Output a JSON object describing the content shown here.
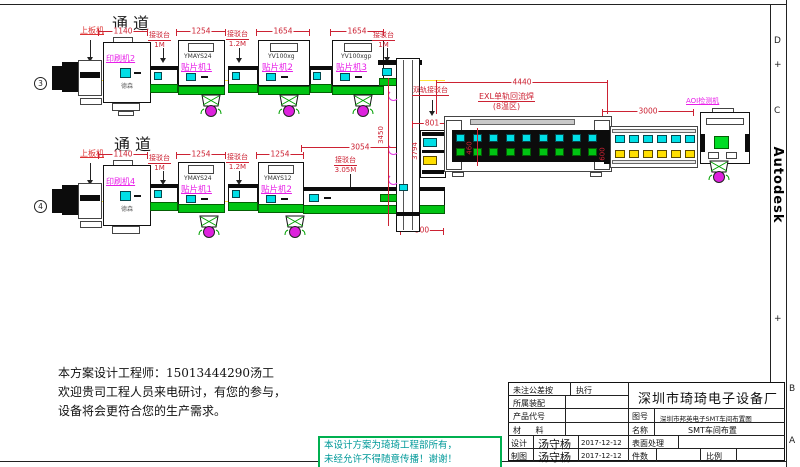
{
  "colors": {
    "dim_red": "#cc2233",
    "label_magenta": "#e81ee8",
    "conveyor_green": "#00c413",
    "slot_cyan": "#00dfe6",
    "slot_yellow": "#ffdf00",
    "machine_black": "#0c0c0c",
    "stamp_teal": "#009999",
    "stamp_border_green": "#00b050"
  },
  "row1": {
    "channel": "通道",
    "marker": "3",
    "loader": "上板机",
    "dim_printer": "1140",
    "printer": {
      "label": "印刷机2",
      "brand": "德森"
    },
    "conn1": {
      "name": "接驳台",
      "size": "1M"
    },
    "dim_m1": "1254",
    "m1": {
      "label": "贴片机1",
      "model": "YMAYS24"
    },
    "conn2": {
      "name": "接驳台",
      "size": "1.2M"
    },
    "dim_m2": "1654",
    "m2": {
      "label": "贴片机2",
      "model": "YV100xg"
    },
    "dim_m3": "1654",
    "m3": {
      "label": "贴片机3",
      "model": "YV100xgp"
    },
    "conn3": {
      "name": "接驳台",
      "size": "1M"
    }
  },
  "row2": {
    "channel": "通道",
    "marker": "4",
    "loader": "上板机",
    "dim_printer": "1140",
    "printer": {
      "label": "印刷机4",
      "brand": "德森"
    },
    "conn1": {
      "name": "接驳台",
      "size": "1M"
    },
    "dim_m1": "1254",
    "m1": {
      "label": "贴片机1",
      "model": "YMAYS24"
    },
    "conn2": {
      "name": "接驳台",
      "size": "1.2M"
    },
    "dim_m2": "1254",
    "m2": {
      "label": "贴片机2",
      "model": "YMAYS12"
    },
    "long_conn": {
      "name": "接驳台",
      "size": "3.05M",
      "dim": "3054"
    },
    "dim_500": "500"
  },
  "center": {
    "dual_rail": "双轨接驳台",
    "dim_801": "801",
    "dim_v1": "3450",
    "dim_v2": "3794"
  },
  "reflow": {
    "label": "EXL单轨回流焊",
    "zones": "(8温区)",
    "dim": "4440",
    "dim_v": "460"
  },
  "cooling": {
    "dim": "3000",
    "dim_v": "600"
  },
  "aoi": {
    "label": "AOI检测机"
  },
  "notes": {
    "l1": "本方案设计工程师：15013444290汤工",
    "l2": "欢迎贵司工程人员来电研讨，有您的参与，",
    "l3": "设备将会更符合您的生产需求。"
  },
  "stamp": {
    "l1": "本设计方案为琦琦工程部所有，",
    "l2": "未经允许不得随意传播！谢谢！"
  },
  "titleblock": {
    "company": "深圳市琦琦电子设备厂",
    "tol": "未注公差按",
    "exec": "执行",
    "assembly": "所属装配",
    "product": "产品代号",
    "material": "材  料",
    "design": "设计",
    "design_name": "汤守杨",
    "design_date": "2017-12-12",
    "draft": "制图",
    "draft_name": "汤守杨",
    "draft_date": "2017-12-12",
    "fig_label": "图号",
    "fig": "深圳市邦英电子SMT车间布置图",
    "name_label": "名称",
    "name": "SMT车间布置",
    "surface": "表面处理",
    "qty": "件数",
    "scale": "比例"
  },
  "frame": {
    "autodesk": "Autodesk",
    "z_d": "D",
    "z_c": "C",
    "z_b": "B",
    "z_a": "A",
    "plus": "+"
  }
}
